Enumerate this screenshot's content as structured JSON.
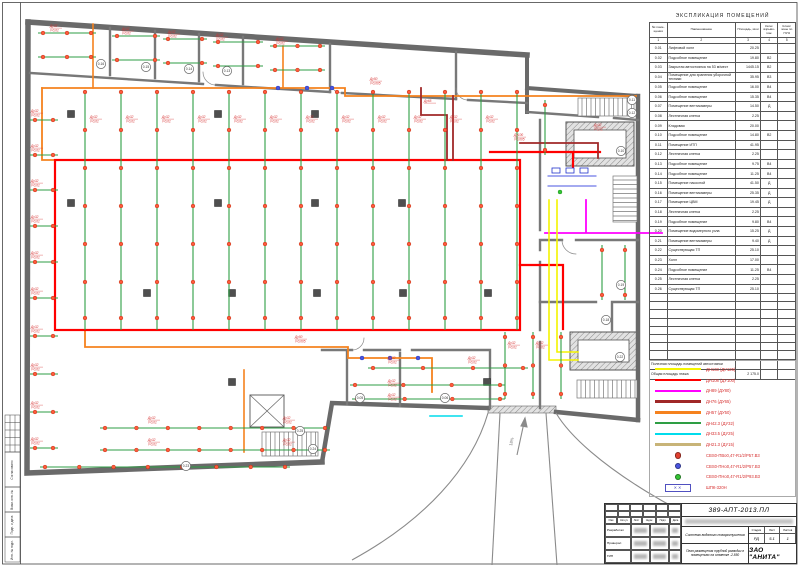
{
  "sheet": {
    "doc_number": "389-АПТ-2013.ПЛ",
    "company": "ЗАО \"АНИТА\"",
    "system_title": "Система водяного пожаротушения",
    "sheet_title": "План размещения трубной разводки в помещениях на отметке -2.850",
    "stage_label": "Стадия",
    "sheet_label": "Лист",
    "sheets_label": "Листов",
    "stage": "РД",
    "sheet_no": "5.1",
    "sheets_total": "1",
    "sig_cols": [
      "Изм",
      "Кол.уч",
      "Лист",
      "№док",
      "Подп.",
      "Дата"
    ],
    "sig_roles": [
      "Разработал",
      "Проверил",
      "ГИП"
    ],
    "margin_labels": [
      "Согласовано",
      "Взам. инв. №",
      "Подп. и дата",
      "Инв. № подл."
    ]
  },
  "explication": {
    "title": "ЭКСПЛИКАЦИЯ  ПОМЕЩЕНИЙ",
    "col_headers": [
      "№ поме- щения",
      "Наименование",
      "Площадь, кв.м",
      "Катег. взрыво- пож.",
      "Класс зоны по ПУЭ"
    ],
    "col_numbers": [
      "1",
      "2",
      "3",
      "4",
      "5"
    ],
    "rows": [
      [
        "0.01",
        "Лифтовой холл",
        "20.25",
        "",
        ""
      ],
      [
        "0.02",
        "Подсобное помещение",
        "19.80",
        "В2",
        ""
      ],
      [
        "0.03",
        "Закрытая автостоянка на 53 м/мест",
        "1445.15",
        "В2",
        ""
      ],
      [
        "0.04",
        "Помещение для хранения уборочной техники",
        "35.95",
        "В3",
        ""
      ],
      [
        "0.05",
        "Подсобное помещение",
        "16.00",
        "В4",
        ""
      ],
      [
        "0.06",
        "Подсобное помещение",
        "15.35",
        "В4",
        ""
      ],
      [
        "0.07",
        "Помещение вентикамеры",
        "14.50",
        "Д",
        ""
      ],
      [
        "0.08",
        "Лестничная клетка",
        "2.25",
        "",
        ""
      ],
      [
        "0.09",
        "Кладовая",
        "20.00",
        "",
        ""
      ],
      [
        "0.10",
        "Подсобное помещение",
        "14.80",
        "В2",
        ""
      ],
      [
        "0.11",
        "Помещение ИТП",
        "41.95",
        "",
        ""
      ],
      [
        "0.12",
        "Лестничная клетка",
        "2.25",
        "",
        ""
      ],
      [
        "0.13",
        "Подсобное помещение",
        "9.75",
        "В4",
        ""
      ],
      [
        "0.14",
        "Подсобное помещение",
        "11.25",
        "В4",
        ""
      ],
      [
        "0.15",
        "Помещение насосной",
        "41.50",
        "Д",
        ""
      ],
      [
        "0.16",
        "Помещение вентикамеры",
        "25.35",
        "Д",
        ""
      ],
      [
        "0.17",
        "Помещение ЦВМ",
        "19.45",
        "Д",
        ""
      ],
      [
        "0.18",
        "Лестничная клетка",
        "2.25",
        "",
        ""
      ],
      [
        "0.19",
        "Подсобное помещение",
        "9.80",
        "В4",
        ""
      ],
      [
        "0.20",
        "Помещение водомерного узла",
        "15.25",
        "Д",
        ""
      ],
      [
        "0.21",
        "Помещение вентикамеры",
        "9.40",
        "Д",
        ""
      ],
      [
        "0.22",
        "Существующая ТП",
        "25.10",
        "",
        ""
      ],
      [
        "0.23",
        "Холл",
        "17.00",
        "",
        ""
      ],
      [
        "0.24",
        "Подсобное помещение",
        "11.25",
        "В4",
        ""
      ],
      [
        "0.25",
        "Лестничная клетка",
        "2.25",
        "",
        ""
      ],
      [
        "0.26",
        "Существующая ТП",
        "25.10",
        "",
        ""
      ]
    ],
    "empty_rows": 8,
    "footer": [
      [
        "Полезная площадь помещений автостоянки",
        ""
      ],
      [
        "Общая площадь этажа",
        "2 175.0"
      ]
    ]
  },
  "legend": {
    "items": [
      {
        "swatch": "line",
        "color": "#f4f400",
        "label": "ДН133 (ДУ125)"
      },
      {
        "swatch": "line",
        "color": "#ff0000",
        "label": "ДН108 (ДУ100)"
      },
      {
        "swatch": "line",
        "color": "#ff00ff",
        "label": "ДН89 (ДУ80)"
      },
      {
        "swatch": "line",
        "color": "#a02828",
        "label": "ДН76 (ДУ65)"
      },
      {
        "swatch": "line",
        "color": "#f5821e",
        "label": "ДН57 (ДУ50)"
      },
      {
        "swatch": "line",
        "color": "#2e9e44",
        "label": "ДН42.3 (ДУ32)"
      },
      {
        "swatch": "line",
        "color": "#00dcec",
        "label": "ДН33.5 (ДУ25)"
      },
      {
        "swatch": "line",
        "color": "#c8b478",
        "label": "ДН21.3 (ДУ15)"
      },
      {
        "swatch": "dot",
        "color": "#e04030",
        "label": "СВS0-ПВо0,47-R1/2/Р57.В3"
      },
      {
        "swatch": "dot",
        "color": "#4a55e0",
        "label": "СВS0-ПНо0,47-R1/2/Р57.В3"
      },
      {
        "swatch": "dot",
        "color": "#35c435",
        "label": "СВS0-ПНо0,47-R1/2/Р93.В3"
      },
      {
        "swatch": "cabinet",
        "color": "#5050c0",
        "label": "ШПК-320Н"
      }
    ]
  },
  "plan": {
    "colors": {
      "wall": "#6a6a6a",
      "part": "#787878",
      "orange": "#f5821e",
      "green": "#2e9e44",
      "red": "#ff0000",
      "darkred": "#a02828",
      "yellow": "#f4f400",
      "magenta": "#ff00ff",
      "cyan": "#00dcec",
      "blue": "#4a55e0",
      "sprinkler": "#ff5a3c",
      "label": "#d63030"
    },
    "ramp_label": "18%",
    "default_pipe_label": [
      "Ду32",
      "i=0,01"
    ],
    "grid": {
      "xs": [
        85,
        121,
        157,
        193,
        229,
        265,
        301,
        337,
        373,
        409,
        445,
        481,
        517
      ],
      "y1": 90,
      "y2": 330,
      "dot_ys": [
        92,
        130,
        168,
        206,
        244,
        282,
        318
      ]
    },
    "branches": [
      [
        38,
        33,
        96,
        33,
        3
      ],
      [
        38,
        57,
        96,
        57,
        3
      ],
      [
        112,
        36,
        160,
        36,
        2
      ],
      [
        112,
        60,
        160,
        60,
        2
      ],
      [
        163,
        39,
        207,
        39,
        2
      ],
      [
        163,
        63,
        207,
        63,
        2
      ],
      [
        213,
        42,
        263,
        42,
        2
      ],
      [
        213,
        66,
        263,
        66,
        2
      ],
      [
        270,
        46,
        325,
        46,
        3
      ],
      [
        270,
        70,
        325,
        70,
        3
      ],
      [
        30,
        120,
        58,
        120,
        2
      ],
      [
        30,
        155,
        58,
        155,
        2
      ],
      [
        30,
        190,
        58,
        190,
        2
      ],
      [
        30,
        226,
        58,
        226,
        2
      ],
      [
        30,
        262,
        58,
        262,
        2
      ],
      [
        30,
        298,
        58,
        298,
        2
      ],
      [
        30,
        336,
        58,
        336,
        2
      ],
      [
        30,
        374,
        58,
        374,
        2
      ],
      [
        30,
        412,
        58,
        412,
        2
      ],
      [
        30,
        448,
        58,
        448,
        2
      ],
      [
        100,
        428,
        330,
        428,
        8
      ],
      [
        100,
        450,
        330,
        450,
        8
      ],
      [
        40,
        467,
        290,
        467,
        8
      ],
      [
        368,
        368,
        528,
        368,
        4
      ],
      [
        350,
        385,
        505,
        385,
        4
      ],
      [
        352,
        399,
        505,
        399,
        4
      ],
      [
        505,
        332,
        505,
        399,
        3
      ],
      [
        533,
        332,
        533,
        399,
        3
      ],
      [
        561,
        332,
        561,
        399,
        3
      ],
      [
        602,
        245,
        602,
        300,
        2
      ],
      [
        625,
        245,
        625,
        300,
        2
      ],
      [
        545,
        100,
        545,
        155,
        2
      ]
    ],
    "blue_dots": [
      [
        278,
        88
      ],
      [
        307,
        88
      ],
      [
        332,
        88
      ],
      [
        362,
        358
      ],
      [
        390,
        358
      ],
      [
        418,
        358
      ]
    ],
    "green_dots": [
      [
        560,
        192
      ]
    ],
    "columns": [
      [
        71,
        114
      ],
      [
        218,
        114
      ],
      [
        315,
        114
      ],
      [
        71,
        203
      ],
      [
        218,
        203
      ],
      [
        315,
        203
      ],
      [
        402,
        203
      ],
      [
        147,
        293
      ],
      [
        232,
        293
      ],
      [
        317,
        293
      ],
      [
        403,
        293
      ],
      [
        488,
        293
      ],
      [
        232,
        382
      ],
      [
        487,
        382
      ]
    ],
    "bubbles": [
      [
        101,
        64,
        "0.16"
      ],
      [
        146,
        67,
        "0.15"
      ],
      [
        189,
        69,
        "0.14"
      ],
      [
        227,
        71,
        "0.13"
      ],
      [
        632,
        100,
        "0.11"
      ],
      [
        632,
        113,
        "0.12"
      ],
      [
        621,
        151,
        "0.10"
      ],
      [
        621,
        285,
        "0.19"
      ],
      [
        606,
        320,
        "0.18"
      ],
      [
        620,
        357,
        "0.22"
      ],
      [
        300,
        431,
        "0.25"
      ],
      [
        313,
        449,
        "0.24"
      ],
      [
        186,
        466,
        "0.23"
      ],
      [
        360,
        398,
        "0.05"
      ],
      [
        445,
        398,
        "0.06"
      ]
    ],
    "labels": [
      [
        50,
        27
      ],
      [
        122,
        30
      ],
      [
        168,
        33
      ],
      [
        216,
        36
      ],
      [
        276,
        40
      ],
      [
        90,
        118
      ],
      [
        126,
        118
      ],
      [
        162,
        118
      ],
      [
        198,
        118
      ],
      [
        234,
        118
      ],
      [
        270,
        118
      ],
      [
        306,
        118
      ],
      [
        342,
        118
      ],
      [
        378,
        118
      ],
      [
        414,
        118
      ],
      [
        450,
        118
      ],
      [
        486,
        118
      ],
      [
        31,
        112
      ],
      [
        31,
        147
      ],
      [
        31,
        182
      ],
      [
        31,
        218
      ],
      [
        31,
        254
      ],
      [
        31,
        290
      ],
      [
        31,
        328
      ],
      [
        31,
        366
      ],
      [
        31,
        404
      ],
      [
        31,
        440
      ],
      [
        148,
        419
      ],
      [
        283,
        419
      ],
      [
        148,
        441
      ],
      [
        283,
        441
      ],
      [
        388,
        359
      ],
      [
        468,
        359
      ],
      [
        388,
        382
      ],
      [
        388,
        396
      ],
      [
        370,
        80,
        "Ду50",
        "i=0,005"
      ],
      [
        295,
        338,
        "Ду50",
        "i=0,005"
      ],
      [
        424,
        102,
        "Ду65",
        ""
      ],
      [
        514,
        136,
        "Ду100",
        "i=0,005"
      ],
      [
        594,
        126,
        "Ду32",
        "i=0,01"
      ],
      [
        508,
        344,
        "Ду32",
        "i=0,01"
      ],
      [
        536,
        344,
        "Ду32",
        "i=0,01"
      ]
    ]
  }
}
